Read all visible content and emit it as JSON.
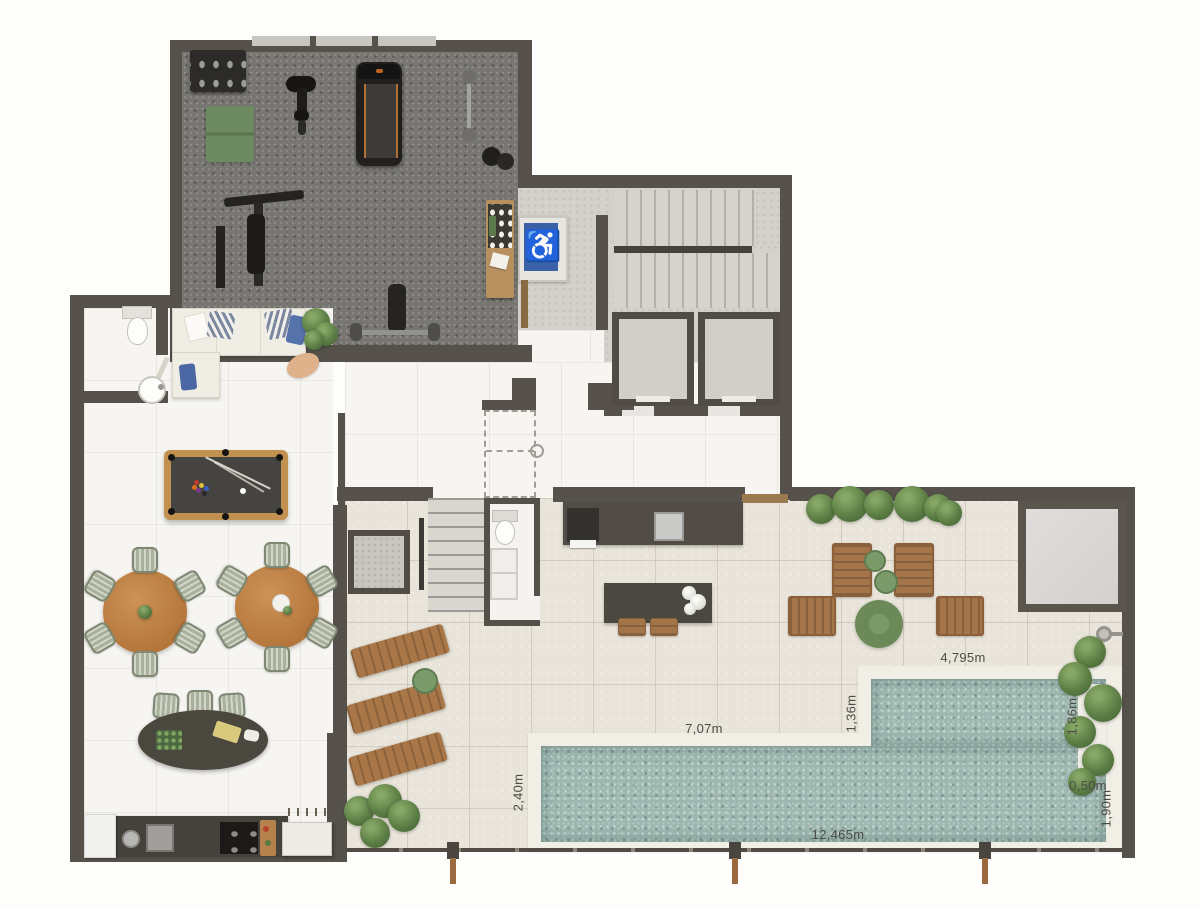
{
  "floorplan": {
    "description": "Rooftop amenities floor plan: gym, games lounge, kitchen, stair and elevator core, terrace with pool",
    "measurements": {
      "pool_upper_top": "4,795m",
      "pool_upper_left": "1,36m",
      "pool_upper_right": "1,86m",
      "pool_lower_top": "7,07m",
      "pool_lower_left": "2,40m",
      "pool_lower_bottom": "12,465m",
      "pool_ledge_width": "0,50m",
      "pool_lower_right": "1,90m"
    },
    "icons": {
      "accessibility": "♿"
    },
    "colors": {
      "wall": "#56524b",
      "indoor_tile": "#f6f5f2",
      "terrace_tile": "#e9e4d9",
      "gym_carpet": "#787672",
      "pool_water": "#9db7b0",
      "pool_deck": "#f1eee6",
      "wood": "#aa7848",
      "sage_chair": "#a9b19c",
      "accessibility_blue": "#3b61a6",
      "plant_green": "#5d7f46"
    }
  }
}
